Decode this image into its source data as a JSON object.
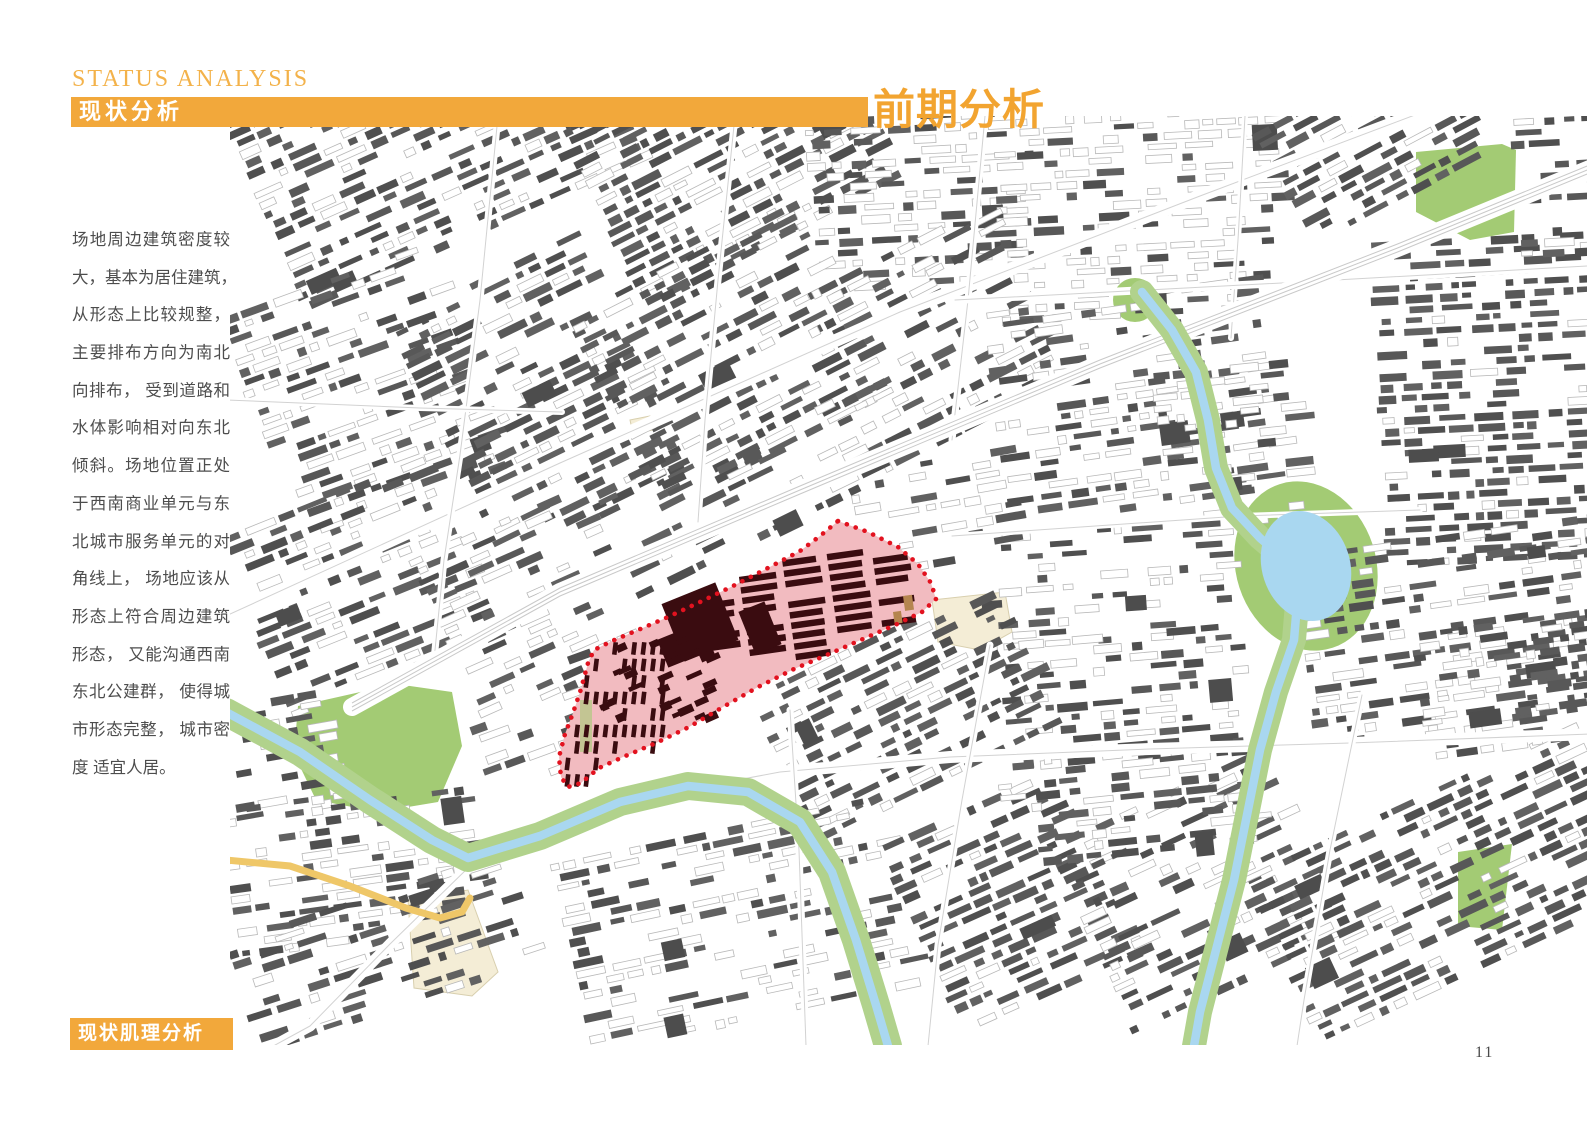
{
  "page": {
    "width": 1587,
    "height": 1122,
    "background": "#ffffff",
    "page_number": "11"
  },
  "header": {
    "eyebrow": "STATUS ANALYSIS",
    "bar_title": "现状分析",
    "page_title": "前期分析",
    "accent_color": "#F2A83B",
    "eyebrow_color": "#F3B24A",
    "page_title_color": "#F2A430"
  },
  "sidebar": {
    "text_color": "#4D4D4D",
    "lines": [
      "场地周边建筑密度较",
      "大，基本为居住建筑，",
      "从形态上比较规整，",
      "主要排布方向为南北",
      "向排布， 受到道路和",
      "水体影响相对向东北",
      "倾斜。场地位置正处",
      "于西南商业单元与东",
      "北城市服务单元的对",
      "角线上， 场地应该从",
      "形态上符合周边建筑",
      "形态， 又能沟通西南",
      "东北公建群， 使得城",
      "市形态完整， 城市密",
      "度 适宜人居。"
    ]
  },
  "footer": {
    "box_label": "现状肌理分析"
  },
  "map": {
    "frame": {
      "left": 230,
      "top": 116,
      "width": 1357,
      "height": 929
    },
    "colors": {
      "bg": "#ffffff",
      "building_darks": [
        "#4f4f4f",
        "#585858",
        "#616161"
      ],
      "building_light_stroke": "#b8b8b8",
      "road": "#ffffff",
      "road_line": "#d2d2d2",
      "green": "#A3CB74",
      "river_green": "#B1D28C",
      "water": "#A9D7F0",
      "beige": "#F4EDD6",
      "beige_stroke": "#d8cfae",
      "yellow_road": "#EFC768",
      "site_fill": "#F2BBC0",
      "site_dot": "#E2121F",
      "site_building": "#3A0C10",
      "site_tan": "#B5854F"
    },
    "districts": [
      [
        232,
        118,
        335,
        200,
        -24,
        0.75,
        0.85
      ],
      [
        232,
        325,
        185,
        215,
        -20,
        0.6,
        0.45
      ],
      [
        232,
        545,
        195,
        175,
        -22,
        0.55,
        0.75
      ],
      [
        232,
        715,
        75,
        95,
        -10,
        0.45,
        0.6
      ],
      [
        232,
        818,
        215,
        125,
        -8,
        0.55,
        0.55
      ],
      [
        238,
        948,
        260,
        92,
        -18,
        0.5,
        0.8
      ],
      [
        402,
        328,
        175,
        235,
        -26,
        0.7,
        0.85
      ],
      [
        425,
        565,
        145,
        165,
        -24,
        0.5,
        0.5
      ],
      [
        562,
        118,
        252,
        195,
        -27,
        0.75,
        0.85
      ],
      [
        818,
        118,
        185,
        165,
        -3,
        0.65,
        0.5
      ],
      [
        1005,
        118,
        250,
        195,
        -3,
        0.6,
        0.35
      ],
      [
        1258,
        118,
        165,
        130,
        -28,
        0.7,
        0.9
      ],
      [
        580,
        322,
        225,
        190,
        -27,
        0.7,
        0.8
      ],
      [
        808,
        305,
        185,
        170,
        -27,
        0.5,
        0.6
      ],
      [
        995,
        322,
        245,
        195,
        -8,
        0.6,
        0.6
      ],
      [
        1382,
        252,
        205,
        300,
        -3,
        0.75,
        0.9
      ],
      [
        1520,
        118,
        67,
        132,
        -3,
        0.5,
        0.8
      ],
      [
        1302,
        565,
        285,
        170,
        -8,
        0.6,
        0.65
      ],
      [
        985,
        545,
        225,
        95,
        -4,
        0.45,
        0.4
      ],
      [
        1012,
        652,
        205,
        108,
        -5,
        0.55,
        0.6
      ],
      [
        762,
        702,
        235,
        140,
        -26,
        0.7,
        0.85
      ],
      [
        565,
        872,
        300,
        168,
        -12,
        0.55,
        0.5
      ],
      [
        892,
        852,
        170,
        188,
        -24,
        0.75,
        0.85
      ],
      [
        1062,
        852,
        200,
        188,
        -25,
        0.6,
        0.7
      ],
      [
        1258,
        882,
        330,
        158,
        -25,
        0.7,
        0.85
      ],
      [
        1425,
        642,
        162,
        112,
        -8,
        0.55,
        0.6
      ],
      [
        604,
        497,
        240,
        100,
        -26,
        0.35,
        0.7
      ],
      [
        472,
        702,
        95,
        100,
        -20,
        0.4,
        0.5
      ],
      [
        862,
        482,
        125,
        88,
        -10,
        0.4,
        0.5
      ],
      [
        1165,
        382,
        115,
        140,
        -6,
        0.45,
        0.45
      ],
      [
        1008,
        772,
        215,
        85,
        -6,
        0.5,
        0.6
      ]
    ],
    "roads": [
      {
        "w": 13,
        "pts": [
          [
            228,
            615
          ],
          [
            560,
            463
          ],
          [
            900,
            312
          ],
          [
            1200,
            196
          ],
          [
            1460,
            98
          ]
        ]
      },
      {
        "w": 12,
        "pts": [
          [
            462,
            868
          ],
          [
            620,
            802
          ],
          [
            780,
            772
          ],
          [
            950,
            757
          ],
          [
            1150,
            749
          ],
          [
            1350,
            743
          ],
          [
            1590,
            734
          ]
        ]
      },
      {
        "w": 11,
        "pts": [
          [
            470,
            866
          ],
          [
            390,
            944
          ],
          [
            310,
            1026
          ],
          [
            266,
            1050
          ]
        ]
      },
      {
        "w": 7,
        "pts": [
          [
            498,
            116
          ],
          [
            480,
            300
          ],
          [
            460,
            455
          ],
          [
            444,
            560
          ],
          [
            434,
            660
          ]
        ]
      },
      {
        "w": 7,
        "pts": [
          [
            735,
            116
          ],
          [
            718,
            280
          ],
          [
            705,
            420
          ],
          [
            698,
            522
          ]
        ]
      },
      {
        "w": 7,
        "pts": [
          [
            790,
            710
          ],
          [
            799,
            850
          ],
          [
            806,
            1046
          ]
        ]
      },
      {
        "w": 7,
        "pts": [
          [
            985,
            116
          ],
          [
            968,
            300
          ],
          [
            952,
            440
          ]
        ]
      },
      {
        "w": 6,
        "pts": [
          [
            1245,
            116
          ],
          [
            1238,
            240
          ],
          [
            1231,
            338
          ]
        ]
      },
      {
        "w": 7,
        "pts": [
          [
            990,
            645
          ],
          [
            962,
            800
          ],
          [
            938,
            945
          ],
          [
            928,
            1046
          ]
        ]
      },
      {
        "w": 7,
        "pts": [
          [
            1362,
            695
          ],
          [
            1330,
            850
          ],
          [
            1304,
            1000
          ],
          [
            1297,
            1046
          ]
        ]
      },
      {
        "w": 8,
        "pts": [
          [
            955,
            300
          ],
          [
            1300,
            282
          ],
          [
            1588,
            266
          ]
        ]
      },
      {
        "w": 6,
        "pts": [
          [
            952,
            536
          ],
          [
            1240,
            516
          ],
          [
            1420,
            510
          ]
        ]
      },
      {
        "w": 6,
        "pts": [
          [
            228,
            400
          ],
          [
            420,
            408
          ],
          [
            562,
            412
          ]
        ]
      }
    ],
    "rail": {
      "w": 18,
      "pts": [
        [
          352,
          707
        ],
        [
          560,
          592
        ],
        [
          800,
          490
        ],
        [
          1100,
          364
        ],
        [
          1400,
          247
        ],
        [
          1592,
          168
        ]
      ]
    },
    "yellow_road": {
      "w": 7,
      "pts": [
        [
          226,
          860
        ],
        [
          290,
          866
        ],
        [
          350,
          886
        ],
        [
          406,
          908
        ],
        [
          440,
          918
        ],
        [
          462,
          912
        ],
        [
          470,
          898
        ]
      ]
    },
    "rivers": [
      {
        "green_w": 28,
        "water_w": 8.5,
        "pts": [
          [
            226,
            712
          ],
          [
            300,
            752
          ],
          [
            370,
            800
          ],
          [
            432,
            840
          ],
          [
            468,
            858
          ],
          [
            540,
            836
          ],
          [
            620,
            802
          ],
          [
            688,
            786
          ],
          [
            748,
            792
          ],
          [
            800,
            822
          ],
          [
            832,
            872
          ],
          [
            856,
            940
          ],
          [
            876,
            1005
          ],
          [
            888,
            1046
          ]
        ]
      },
      {
        "green_w": 24,
        "water_w": 8.5,
        "pts": [
          [
            1142,
            292
          ],
          [
            1172,
            330
          ],
          [
            1196,
            372
          ],
          [
            1208,
            420
          ],
          [
            1216,
            468
          ],
          [
            1232,
            508
          ],
          [
            1260,
            538
          ],
          [
            1286,
            560
          ],
          [
            1298,
            592
          ],
          [
            1294,
            640
          ],
          [
            1276,
            692
          ],
          [
            1260,
            750
          ],
          [
            1248,
            810
          ],
          [
            1234,
            880
          ],
          [
            1216,
            950
          ],
          [
            1200,
            1012
          ],
          [
            1194,
            1046
          ]
        ]
      }
    ],
    "lake": {
      "cx": 1306,
      "cy": 566,
      "rx": 44,
      "ry": 56,
      "rot": -18,
      "green_rx": 70,
      "green_ry": 86
    },
    "green_blob": {
      "cx": 1135,
      "cy": 300,
      "r": 22
    },
    "greens": [
      [
        [
          298,
          706
        ],
        [
          396,
          684
        ],
        [
          452,
          692
        ],
        [
          462,
          746
        ],
        [
          438,
          802
        ],
        [
          378,
          812
        ],
        [
          316,
          800
        ],
        [
          294,
          754
        ]
      ],
      [
        [
          1416,
          152
        ],
        [
          1502,
          144
        ],
        [
          1516,
          150
        ],
        [
          1514,
          232
        ],
        [
          1470,
          240
        ],
        [
          1416,
          212
        ]
      ],
      [
        [
          1458,
          852
        ],
        [
          1512,
          844
        ],
        [
          1502,
          930
        ],
        [
          1458,
          926
        ]
      ]
    ],
    "beiges": [
      [
        [
          932,
          600
        ],
        [
          1005,
          592
        ],
        [
          1012,
          632
        ],
        [
          980,
          650
        ],
        [
          938,
          642
        ]
      ],
      [
        [
          408,
          900
        ],
        [
          468,
          890
        ],
        [
          498,
          972
        ],
        [
          472,
          996
        ],
        [
          414,
          988
        ]
      ],
      [
        [
          630,
          420
        ],
        [
          650,
          416
        ],
        [
          653,
          430
        ],
        [
          633,
          434
        ]
      ]
    ],
    "site": {
      "polygon": [
        [
          838,
          521
        ],
        [
          868,
          532
        ],
        [
          898,
          547
        ],
        [
          918,
          564
        ],
        [
          931,
          583
        ],
        [
          936,
          599
        ],
        [
          922,
          612
        ],
        [
          895,
          625
        ],
        [
          863,
          639
        ],
        [
          829,
          654
        ],
        [
          794,
          669
        ],
        [
          758,
          687
        ],
        [
          723,
          707
        ],
        [
          689,
          727
        ],
        [
          656,
          743
        ],
        [
          623,
          757
        ],
        [
          599,
          768
        ],
        [
          581,
          783
        ],
        [
          568,
          787
        ],
        [
          561,
          777
        ],
        [
          559,
          757
        ],
        [
          565,
          734
        ],
        [
          573,
          713
        ],
        [
          581,
          689
        ],
        [
          588,
          663
        ],
        [
          594,
          650
        ],
        [
          612,
          641
        ],
        [
          638,
          630
        ],
        [
          668,
          617
        ],
        [
          700,
          602
        ],
        [
          733,
          586
        ],
        [
          766,
          569
        ],
        [
          800,
          551
        ],
        [
          820,
          536
        ]
      ],
      "ne_region": [
        [
          686,
          550
        ],
        [
          950,
          550
        ],
        [
          950,
          655
        ],
        [
          770,
          702
        ],
        [
          686,
          628
        ]
      ],
      "grid": {
        "origin": [
          690,
          552
        ],
        "angle": -8,
        "u_len": 255,
        "v_len": 125,
        "pitch": 10.5,
        "row_h": 6.5,
        "col_w": 38,
        "col_gap": 7
      },
      "blobs": [
        [
          700,
          622,
          58,
          62,
          -22
        ],
        [
          760,
          628,
          28,
          46,
          -22
        ],
        [
          672,
          650,
          20,
          30,
          -22
        ]
      ],
      "sw_strips": {
        "x0": 566,
        "x1": 670,
        "y0": 642,
        "y1": 794,
        "dx": 9.5,
        "dy": 16.5,
        "w": 4.6,
        "h": 12.5,
        "rot": 7,
        "density": 0.6
      },
      "green_strip": [
        580,
        700,
        12,
        52
      ],
      "tan_bits": [
        [
          903,
          596,
          9,
          15,
          -8
        ],
        [
          893,
          612,
          8,
          12,
          -8
        ]
      ],
      "dot_width": 4.6,
      "dot_gap": 9.3
    }
  }
}
